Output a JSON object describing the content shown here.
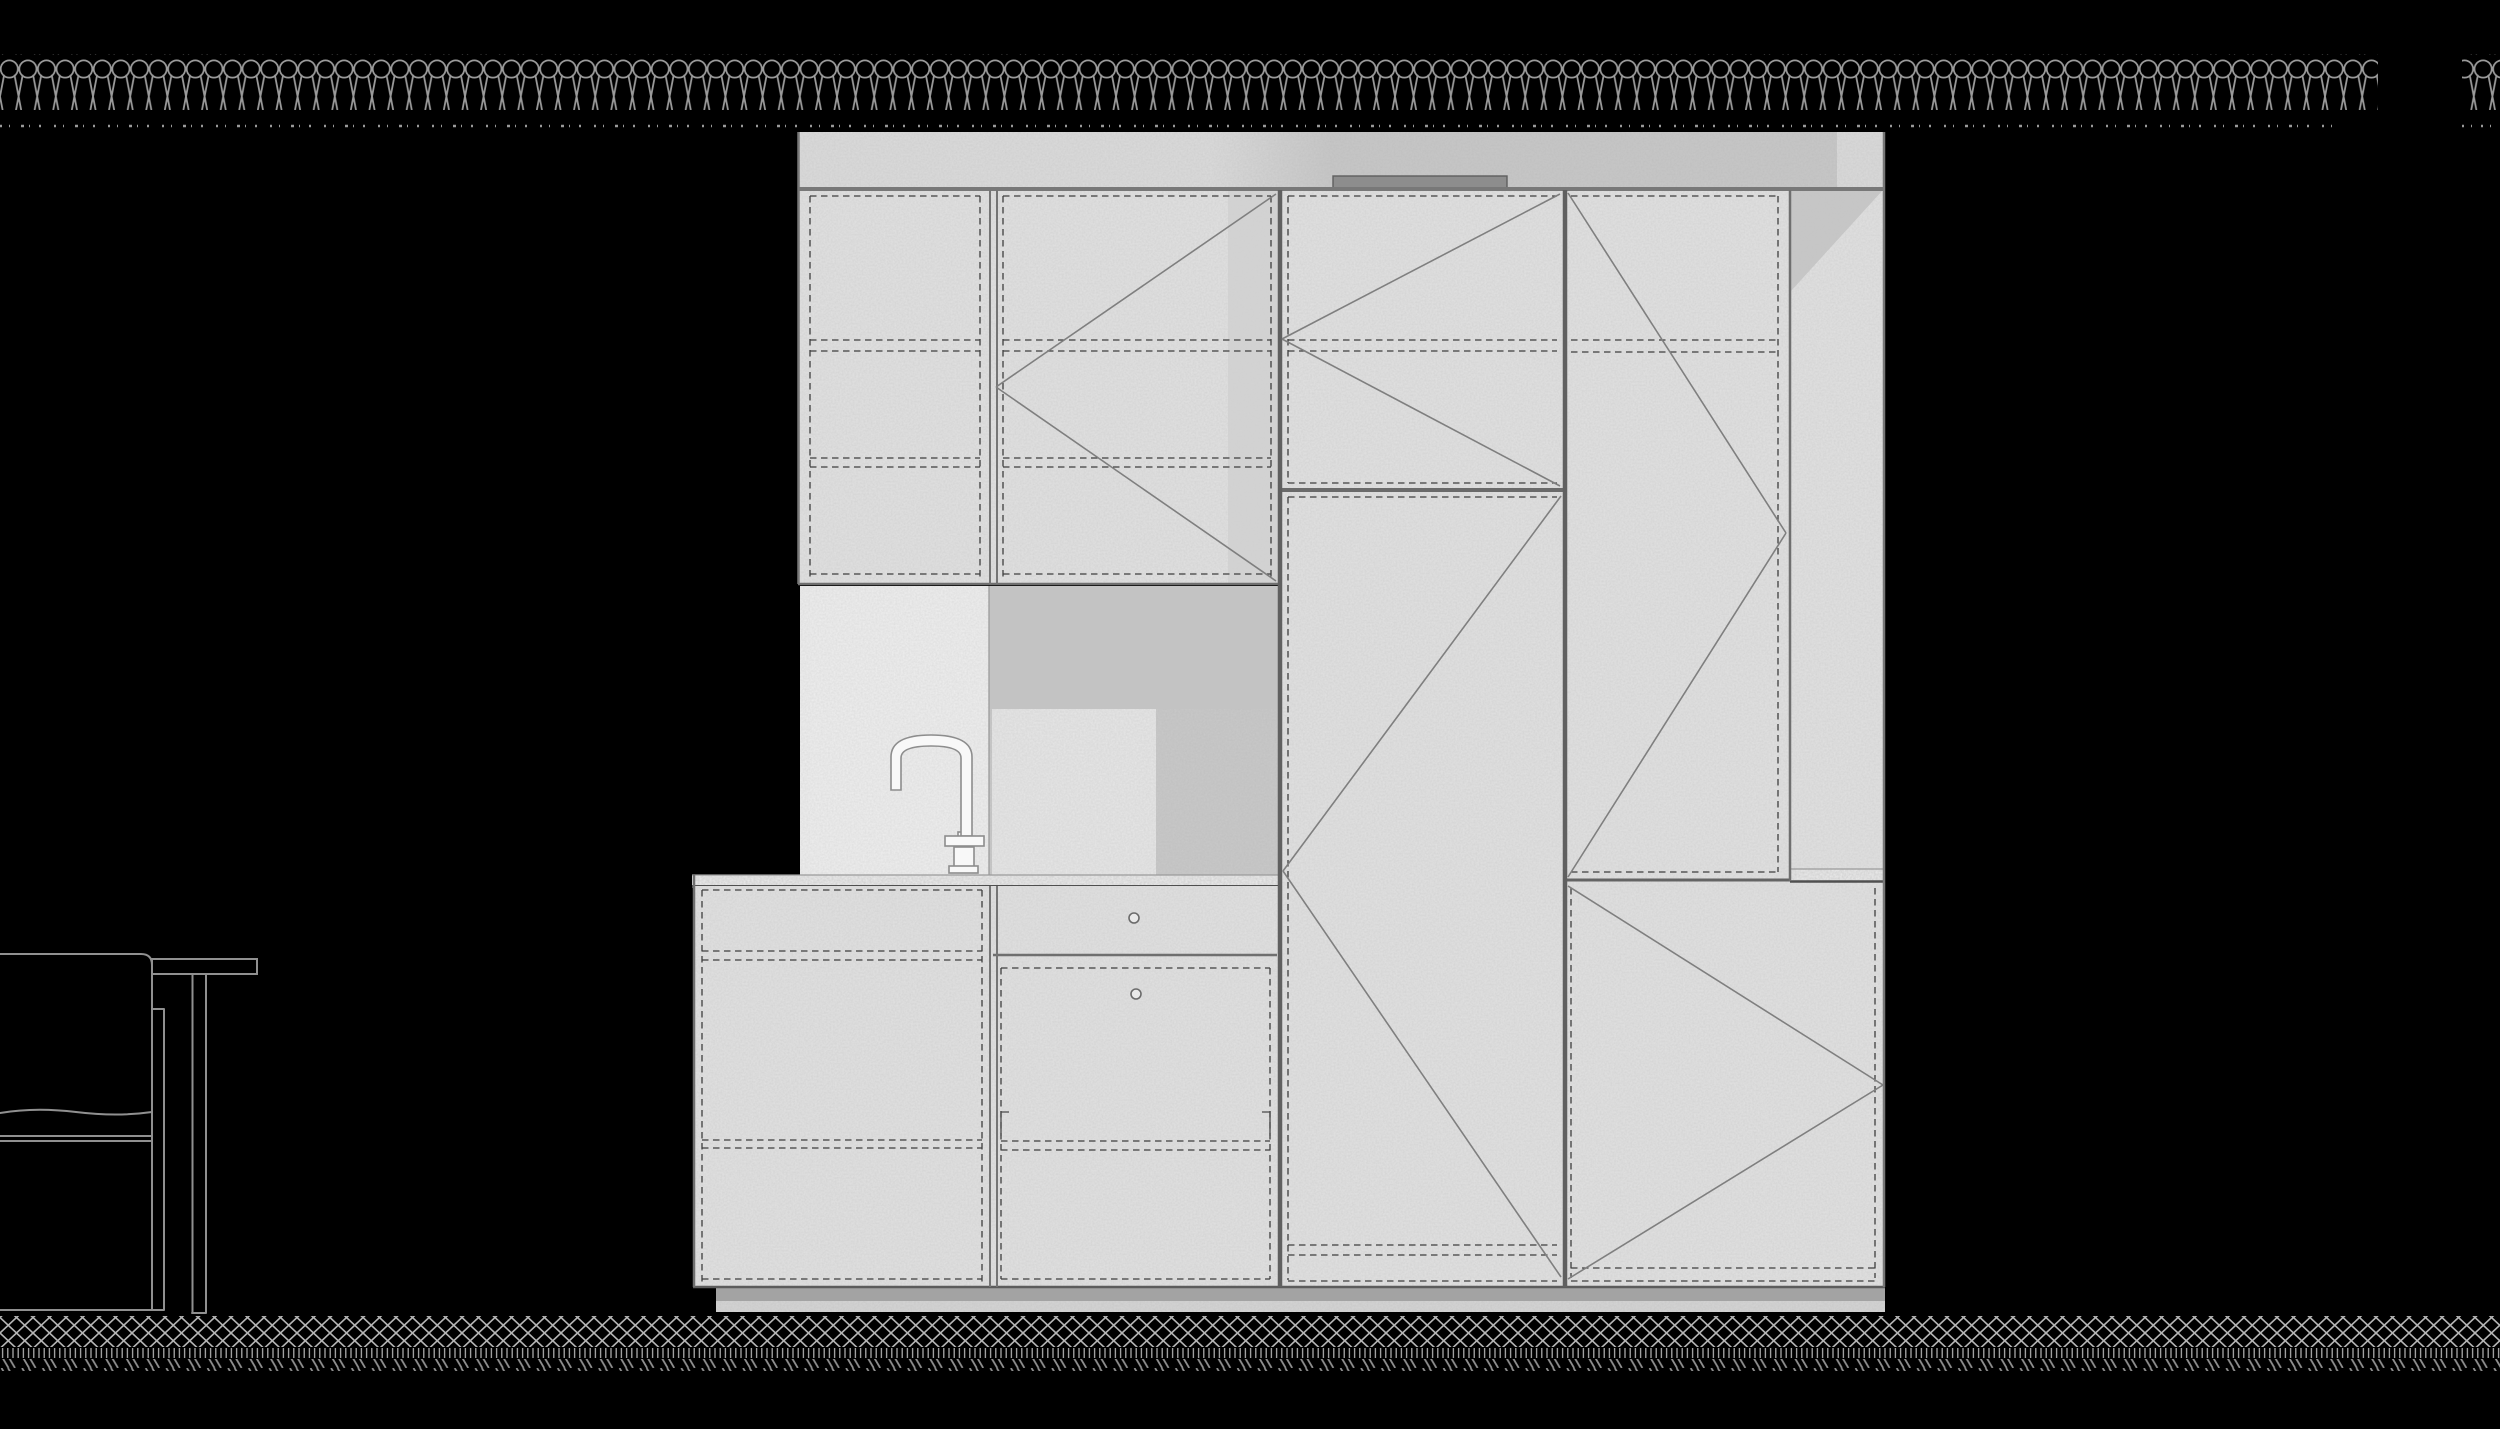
{
  "title": "Kitchen joinery elevation drawing",
  "canvas": {
    "width": 2500,
    "height": 1429,
    "background": "#000000"
  },
  "colors": {
    "background": "#000000",
    "line": "#787878",
    "line_dark": "#4f4f4f",
    "line_light": "#9b9b9b",
    "dashed_line": "#3e3e3e",
    "panel": "#e2e2e2",
    "backsplash": "#efefef",
    "band_left": "#dcdcdc",
    "band_right": "#c8c8c8",
    "band_notch": "#dbdbdb",
    "niche": "#c9c9c9",
    "niche_top": "#c3c3c3",
    "niche_inner": "#e7e7e7",
    "shadow_strip": "#d0d0d0",
    "corner_triangle": "#c3c3c3",
    "vent": "#8d8d8d",
    "vent_edge": "#5f5f5f",
    "counter": "#ededed",
    "toe_dark": "#a3a3a3",
    "toe_light": "#d5d5d5",
    "coil": "#9a9a9a",
    "speckle": "#9a9a9a",
    "hatch": "#b5b5b5",
    "hatch_tick": "#ababab",
    "hatch_diag": "#8f8f8f",
    "diagonal": "#7f7f7f",
    "chair": "#909090",
    "faucet_fill": "#f8f8f8",
    "faucet_line": "#8d8d8d",
    "knob": "#6b6b6b"
  },
  "drawing": {
    "type": "architectural interior elevation, line art on black",
    "insulation_hatch": {
      "symbol": "batt-insulation coil",
      "y": 54,
      "height": 56,
      "segments": [
        {
          "x": 0,
          "width": 2378
        },
        {
          "x": 2462,
          "width": 38
        }
      ],
      "loop_period": 18.6
    },
    "ceiling_dotted_line": {
      "y": 126,
      "segments": [
        [
          0,
          2342
        ],
        [
          2462,
          2498
        ]
      ]
    },
    "cabinet": {
      "bounds": {
        "x": 692,
        "y": 132,
        "width": 1193,
        "height": 1180
      },
      "top_filler_band": {
        "x": 798,
        "y": 132,
        "width": 1087,
        "height": 58,
        "vent_bar": {
          "x": 1333,
          "y": 176,
          "width": 174,
          "height": 13
        }
      },
      "upper_columns": [
        {
          "name": "upper-left-door",
          "x": 798,
          "width": 192,
          "y": 190,
          "height": 394,
          "hinge": "dashed insets"
        },
        {
          "name": "upper-left2-door",
          "x": 990,
          "width": 290,
          "y": 190,
          "height": 394,
          "swing": "apex left-mid"
        },
        {
          "name": "tall-middle-upper-door",
          "x": 1280,
          "width": 285,
          "y": 190,
          "height": 300,
          "swing": "apex left-mid"
        },
        {
          "name": "tall-right-upper-door",
          "x": 1565,
          "width": 225,
          "y": 190,
          "height": 690,
          "swing": "apex right-mid"
        },
        {
          "name": "right-side-panel",
          "x": 1790,
          "width": 95,
          "y": 190,
          "height": 690
        }
      ],
      "tall_middle_lower_door": {
        "x": 1280,
        "width": 285,
        "y": 490,
        "height": 797,
        "swing": "apex left at counter height"
      },
      "right_lower_door": {
        "x": 1565,
        "width": 320,
        "y": 880,
        "height": 407,
        "swing": "apex right-mid"
      },
      "niche": {
        "x": 989,
        "y": 586,
        "width": 291,
        "height": 289,
        "inner_light": {
          "x": 992,
          "y": 709,
          "width": 164,
          "height": 166
        }
      },
      "backsplash_panel": {
        "x": 800,
        "y": 586,
        "width": 189,
        "height": 289
      },
      "countertop": {
        "x": 692,
        "y": 875,
        "width": 588,
        "height": 11
      },
      "side_counter_band": {
        "x": 1790,
        "y": 869,
        "width": 95,
        "height": 12
      },
      "base_cabinets": [
        {
          "name": "base-left-drawers",
          "x": 694,
          "width": 296,
          "y": 886,
          "height": 401
        },
        {
          "name": "base-mid-drawer",
          "x": 990,
          "width": 290,
          "y": 886,
          "height": 69,
          "knob": {
            "cx": 1134,
            "cy": 918
          }
        },
        {
          "name": "base-mid-door",
          "x": 990,
          "width": 290,
          "y": 955,
          "height": 332,
          "knob": {
            "cx": 1136,
            "cy": 994
          }
        }
      ],
      "toe_kick": {
        "x": 716,
        "y": 1287,
        "width": 1169,
        "dark_height": 14,
        "light_height": 11
      }
    },
    "faucet": {
      "type": "gooseneck tap",
      "x": 891,
      "y": 735,
      "spout_tip_y": 790,
      "base_y": 873
    },
    "furniture": {
      "chair": {
        "x": 0,
        "y": 954,
        "width": 164,
        "height": 356
      },
      "side_table": {
        "x": 152,
        "y": 959,
        "width": 105,
        "leg_x": 192,
        "bottom_y": 1313
      }
    },
    "ground_hatch": {
      "lattice": {
        "y": 1316,
        "height": 31
      },
      "ticks": {
        "y": 1348,
        "height": 10
      },
      "diagonal_dashes": {
        "y": 1359,
        "height": 12
      }
    }
  }
}
